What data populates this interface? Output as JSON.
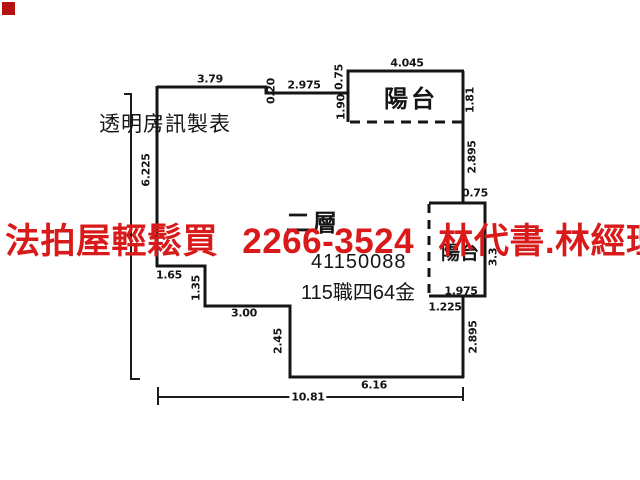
{
  "watermark": {
    "text": "法拍屋輕鬆買 2266-3524 林代書.林經理",
    "color": "#d81a1a"
  },
  "corner_square_color": "#b51111",
  "credit": "透明房訊製表",
  "plan": {
    "floor_label": "二層",
    "registration_number": "41150088",
    "area_text": "115職四64金",
    "balcony_top_label": "陽台",
    "balcony_right_label": "陽台",
    "line_color": "#151515",
    "dims": {
      "top_a": "3.79",
      "top_jog": "0.20",
      "top_b": "2.975",
      "balcony_width": "4.045",
      "balcony_step": "0.75",
      "balcony_left_h": "1.90",
      "balcony_right_h": "1.81",
      "right_upper": "2.895",
      "right_step": "0.75",
      "rbalcony_h": "3.3",
      "rbalcony_w": "1.975",
      "rbalcony_bottom": "1.225",
      "right_lower": "2.895",
      "left_h": "6.225",
      "step1_w": "1.65",
      "step1_h": "1.35",
      "step2_w": "3.00",
      "step2_h": "2.45",
      "bottom_w": "6.16",
      "total_w": "10.81"
    }
  }
}
